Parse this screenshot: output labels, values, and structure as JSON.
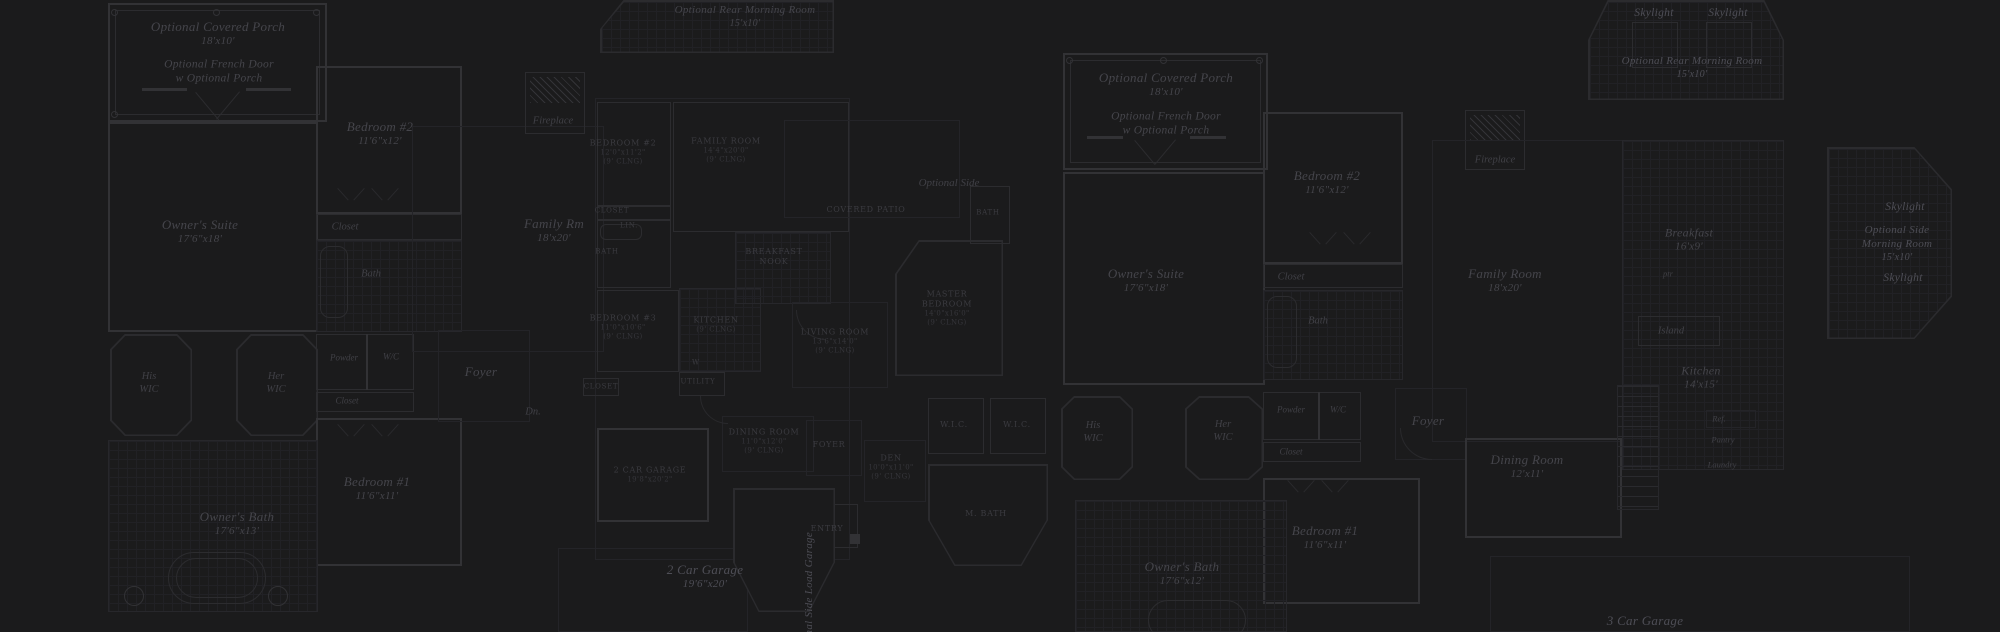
{
  "colors": {
    "background": "#1b1b1c",
    "wall": "#2c2c2f",
    "wall_bright": "#323235",
    "wall_dim": "#242428",
    "grid": "#212125",
    "text_script": "#45454b",
    "text_caps": "#3b3b40",
    "text_bright": "#4e4e56"
  },
  "plan_a": {
    "porch": [
      "Optional Covered Porch",
      "18'x10'"
    ],
    "french_door": [
      "Optional French Door",
      "w Optional Porch"
    ],
    "bedroom2": [
      "Bedroom #2",
      "11'6\"x12'"
    ],
    "owners_suite": [
      "Owner's Suite",
      "17'6\"x18'"
    ],
    "closet1": [
      "Closet"
    ],
    "bath": [
      "Bath"
    ],
    "his_wic": [
      "His",
      "WIC"
    ],
    "her_wic": [
      "Her",
      "WIC"
    ],
    "powder": [
      "Powder"
    ],
    "wc": [
      "W/C"
    ],
    "closet2": [
      "Closet"
    ],
    "bedroom1": [
      "Bedroom #1",
      "11'6\"x11'"
    ],
    "owners_bath": [
      "Owner's Bath",
      "17'6\"x13'"
    ],
    "foyer": [
      "Foyer"
    ],
    "dn": [
      "Dn."
    ],
    "family_rm": [
      "Family Rm",
      "18'x20'"
    ],
    "garage": [
      "2 Car Garage",
      "19'6\"x20'"
    ],
    "side_load": [
      "Optional Side Load Garage"
    ]
  },
  "plan_b": {
    "rear_morning": [
      "Optional Rear Morning Room",
      "15'x10'"
    ],
    "fireplace": [
      "Fireplace"
    ],
    "bedroom2": [
      "BEDROOM #2",
      "12'0\"x11'2\"",
      "(9' CLNG)"
    ],
    "family_room": [
      "FAMILY ROOM",
      "14'4\"x20'0\"",
      "(9' CLNG)"
    ],
    "closet1": [
      "CLOSET"
    ],
    "lin": [
      "LIN."
    ],
    "bath": [
      "BATH"
    ],
    "breakfast": [
      "BREAKFAST",
      "NOOK"
    ],
    "bedroom3": [
      "BEDROOM #3",
      "11'0\"x10'6\"",
      "(9' CLNG)"
    ],
    "kitchen": [
      "KITCHEN",
      "(9' CLNG)"
    ],
    "living": [
      "LIVING ROOM",
      "13'6\"x14'0\"",
      "(9' CLNG)"
    ],
    "utility": [
      "UTILITY"
    ],
    "washer": [
      "W"
    ],
    "closet2": [
      "CLOSET"
    ],
    "dining": [
      "DINING ROOM",
      "11'0\"x12'0\"",
      "(9' CLNG)"
    ],
    "foyer": [
      "FOYER"
    ],
    "den": [
      "DEN",
      "10'0\"x11'0\"",
      "(9' CLNG)"
    ],
    "garage": [
      "2 CAR GARAGE",
      "19'8\"x20'2\""
    ],
    "entry": [
      "ENTRY"
    ],
    "covered_patio": [
      "COVERED PATIO"
    ],
    "optional_side": [
      "Optional Side"
    ],
    "bath2": [
      "BATH"
    ],
    "master": [
      "MASTER",
      "BEDROOM",
      "14'0\"x16'0\"",
      "(9' CLNG)"
    ],
    "wic1": [
      "W.I.C."
    ],
    "wic2": [
      "W.I.C."
    ],
    "mbath": [
      "M. BATH"
    ]
  },
  "plan_c": {
    "porch": [
      "Optional Covered Porch",
      "18'x10'"
    ],
    "french_door": [
      "Optional French Door",
      "w Optional Porch"
    ],
    "bedroom2": [
      "Bedroom #2",
      "11'6\"x12'"
    ],
    "fireplace": [
      "Fireplace"
    ],
    "owners_suite": [
      "Owner's Suite",
      "17'6\"x18'"
    ],
    "closet1": [
      "Closet"
    ],
    "bath": [
      "Bath"
    ],
    "family_room": [
      "Family Room",
      "18'x20'"
    ],
    "his_wic": [
      "His",
      "WIC"
    ],
    "her_wic": [
      "Her",
      "WIC"
    ],
    "powder": [
      "Powder"
    ],
    "wc": [
      "W/C"
    ],
    "closet2": [
      "Closet"
    ],
    "foyer": [
      "Foyer"
    ],
    "dining": [
      "Dining Room",
      "12'x11'"
    ],
    "bedroom1": [
      "Bedroom #1",
      "11'6\"x11'"
    ],
    "owners_bath": [
      "Owner's Bath",
      "17'6\"x12'"
    ],
    "skylight1": [
      "Skylight"
    ],
    "skylight2": [
      "Skylight"
    ],
    "rear_morning": [
      "Optional Rear Morning Room",
      "15'x10'"
    ],
    "breakfast": [
      "Breakfast",
      "16'x9'"
    ],
    "ptr": [
      "ptr"
    ],
    "island": [
      "Island"
    ],
    "kitchen": [
      "Kitchen",
      "14'x15'"
    ],
    "ref": [
      "Ref."
    ],
    "pantry": [
      "Pantry"
    ],
    "laundry": [
      "Laundry"
    ],
    "skylight3": [
      "Skylight"
    ],
    "side_morning": [
      "Optional Side",
      "Morning Room",
      "15'x10'"
    ],
    "skylight4": [
      "Skylight"
    ],
    "garage": [
      "3 Car Garage"
    ]
  }
}
